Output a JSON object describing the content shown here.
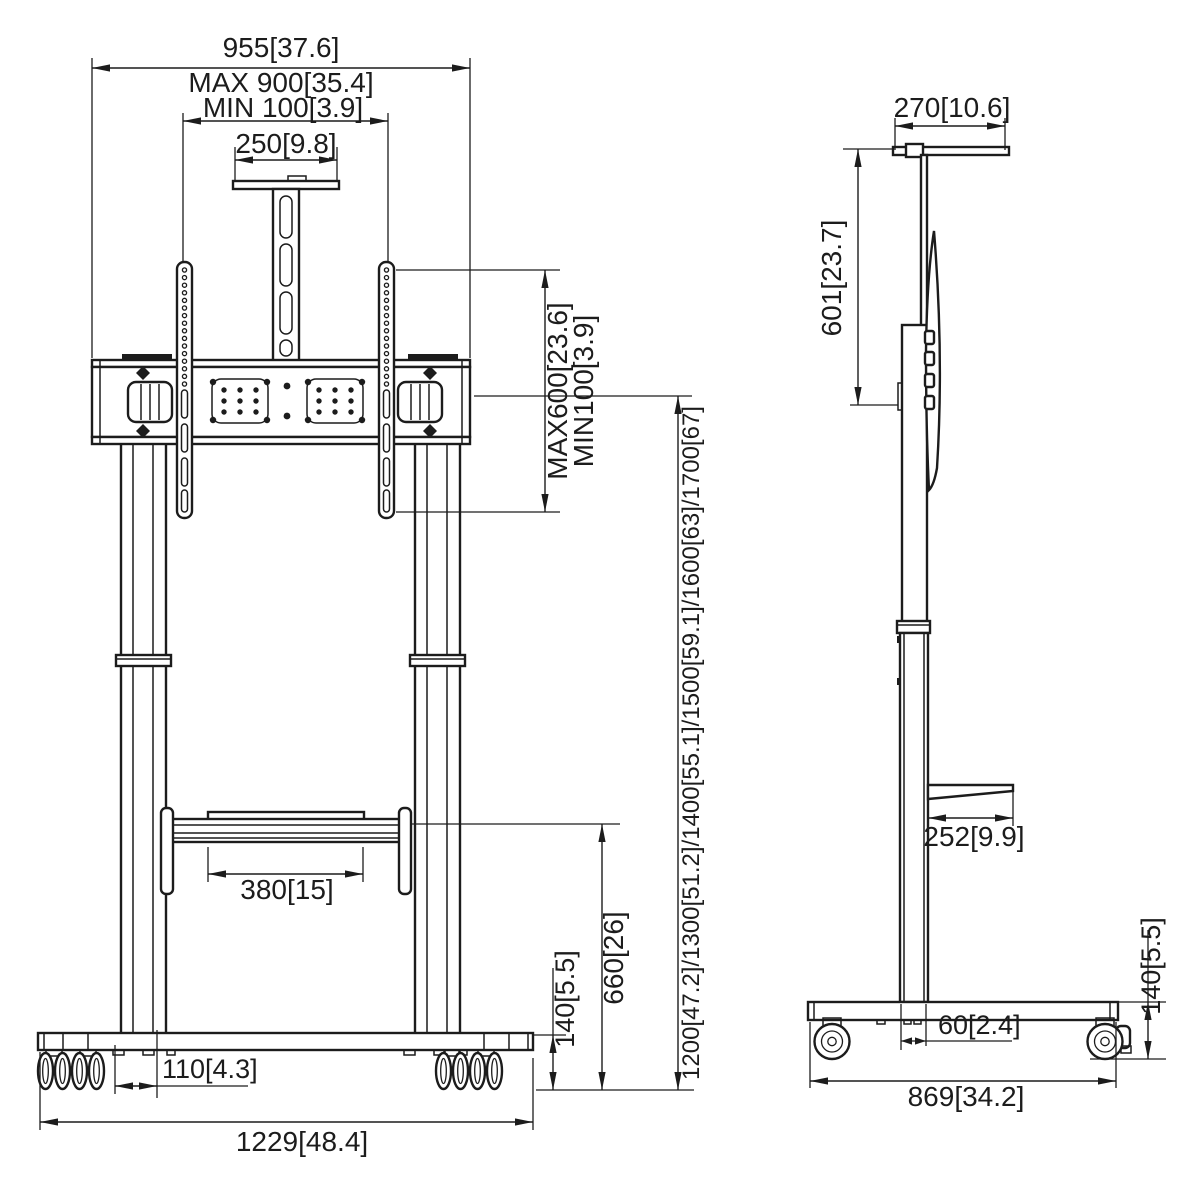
{
  "drawing": {
    "type": "technical-dimension-drawing",
    "subject": "mobile TV stand trolley, front and side orthographic views",
    "units": "mm[inch]",
    "colors": {
      "line": "#1c1c1c",
      "background": "#ffffff"
    },
    "front_view": {
      "dimensions": {
        "total_width": "955[37.6]",
        "vesa_width_max": "MAX 900[35.4]",
        "vesa_width_min": "MIN 100[3.9]",
        "camera_plate_width": "250[9.8]",
        "vesa_height_max": "MAX600[23.6]",
        "vesa_height_min": "MIN100[3.9]",
        "screen_center_heights": "1200[47.2]/1300[51.2]/1400[55.1]/1500[59.1]/1600[63]/1700[67]",
        "shelf_height": "660[26]",
        "base_height": "140[5.5]",
        "shelf_width": "380[15]",
        "caster_inset": "110[4.3]",
        "base_width": "1229[48.4]"
      }
    },
    "side_view": {
      "dimensions": {
        "top_shelf_depth": "270[10.6]",
        "upper_column_height": "601[23.7]",
        "shelf_depth": "252[9.9]",
        "column_depth": "60[2.4]",
        "base_depth": "869[34.2]",
        "base_height": "140[5.5]"
      }
    }
  }
}
